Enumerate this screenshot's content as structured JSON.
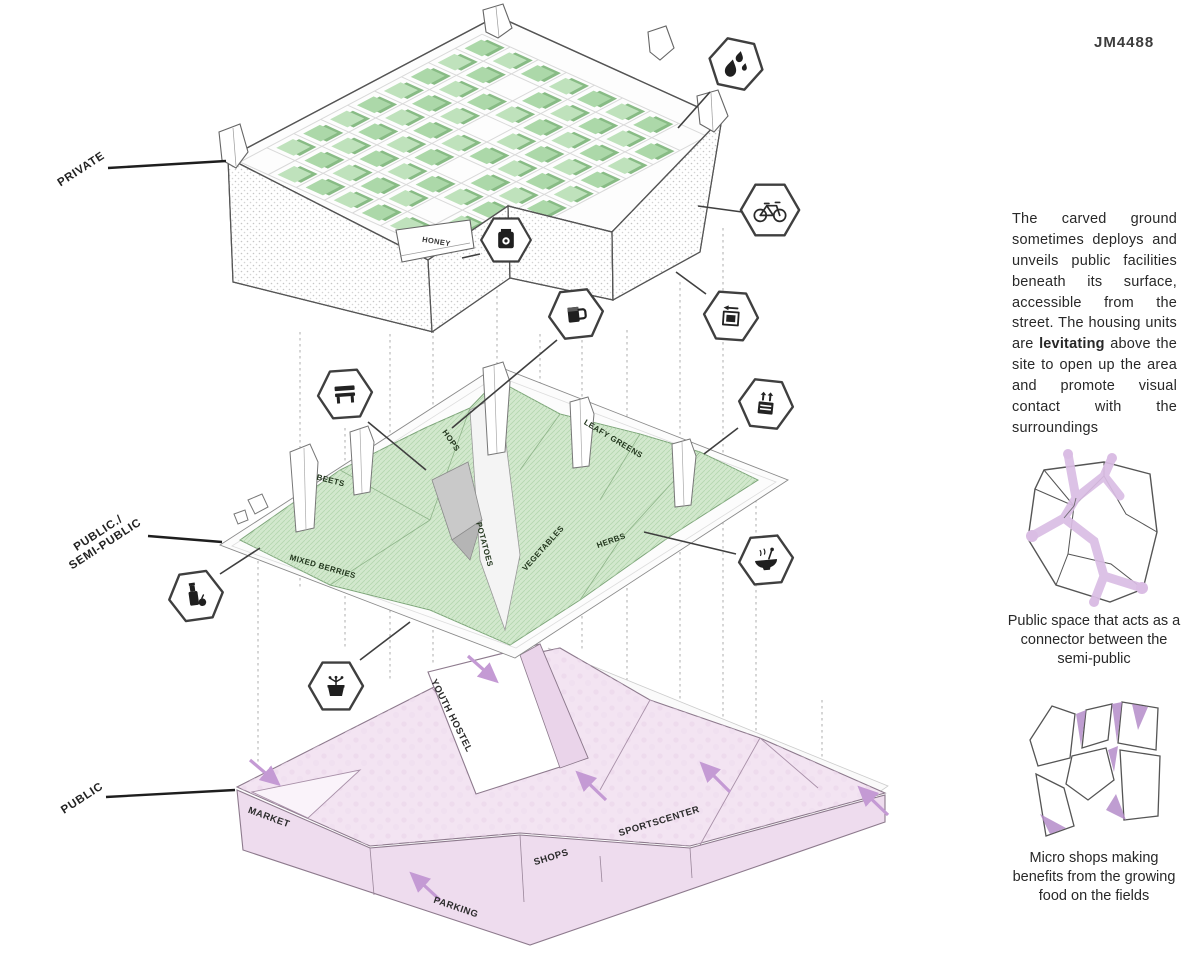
{
  "code": "JM4488",
  "levels": {
    "private": {
      "label": "PRIVATE"
    },
    "semi_public": {
      "label_line1": "PUBLIC./",
      "label_line2": "SEMI-PUBLIC"
    },
    "public": {
      "label": "PUBLIC"
    }
  },
  "top_slab": {
    "honey": "HONEY"
  },
  "farm_labels": {
    "hops": "HOPS",
    "beets": "BEETS",
    "mixed_berries": "MIXED BERRIES",
    "potatoes": "POTATOES",
    "vegetables": "VEGETABLES",
    "herbs": "HERBS",
    "leafy_greens": "LEAFY GREENS"
  },
  "ground_labels": {
    "market": "MARKET",
    "youth_hostel": "YOUTH HOSTEL",
    "shops": "SHOPS",
    "sportscenter": "SPORTSCENTER",
    "parking": "PARKING"
  },
  "icons": [
    {
      "name": "water-drops-icon",
      "glyph": "three water droplets"
    },
    {
      "name": "bicycle-icon",
      "glyph": "bicycle"
    },
    {
      "name": "honey-jar-icon",
      "glyph": "dark jar with round label"
    },
    {
      "name": "beer-mug-icon",
      "glyph": "beer mug"
    },
    {
      "name": "package-return-icon",
      "glyph": "box with left arrow"
    },
    {
      "name": "bench-icon",
      "glyph": "park bench"
    },
    {
      "name": "compost-bin-icon",
      "glyph": "bin with two up arrows"
    },
    {
      "name": "food-bowl-icon",
      "glyph": "steaming bowl with spoon"
    },
    {
      "name": "milk-bottle-icon",
      "glyph": "bottle with fruit"
    },
    {
      "name": "potted-plant-icon",
      "glyph": "sprouting pot"
    }
  ],
  "sidebar": {
    "paragraph_pre": "The carved ground sometimes deploys and unveils public facilities beneath its surface, accessible from the street. The housing units are ",
    "paragraph_bold": "levitating",
    "paragraph_post": " above the site to open up the area and promote visual contact with the surroundings",
    "caption_connector": "Public space that acts as a connector between the semi-public",
    "caption_micro_shops": "Micro shops making benefits from the growing food on the fields"
  },
  "colors": {
    "green_field": "#d2e8cd",
    "green_cube": "#bfe2bc",
    "pink_ground": "#f3e4f2",
    "purple_accent": "#c49ad4",
    "line": "#4a4a4a"
  }
}
